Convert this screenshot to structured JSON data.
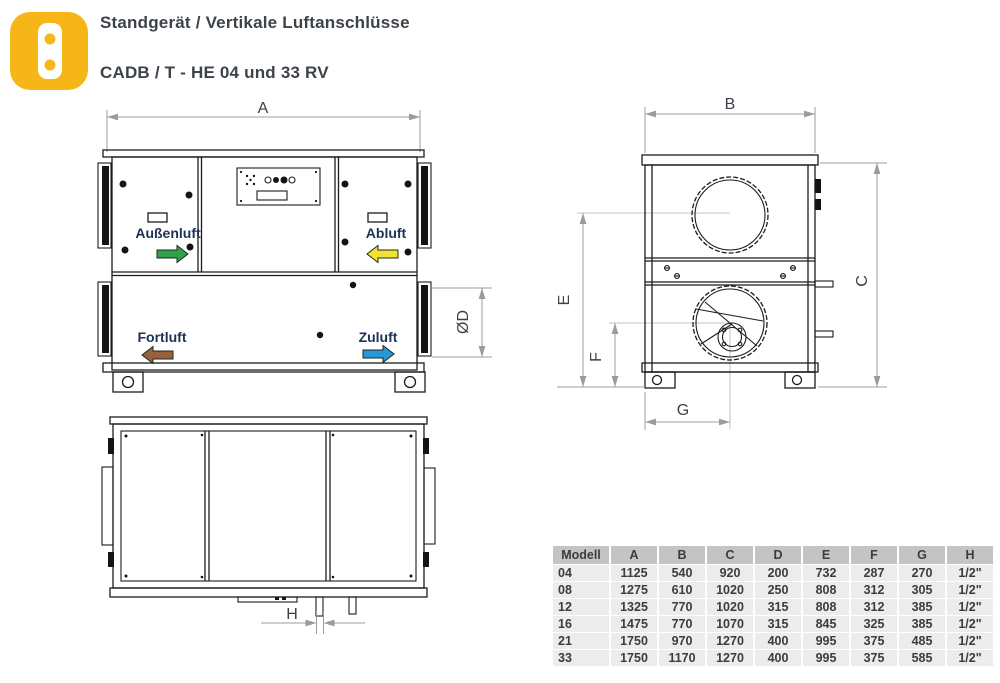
{
  "header": {
    "title": "Standgerät / Vertikale Luftanschlüsse",
    "subtitle": "CADB / T - HE 04 und 33 RV"
  },
  "dimensions": {
    "a": "A",
    "b": "B",
    "c": "C",
    "d": "ØD",
    "e": "E",
    "f": "F",
    "g": "G",
    "h": "H"
  },
  "airflow_labels": {
    "outdoor_air": "Außenluft",
    "extract_air": "Abluft",
    "exhaust_air": "Fortluft",
    "supply_air": "Zuluft"
  },
  "colors": {
    "icon_yellow": "#F7B617",
    "outdoor_air_arrow": "#2FA14B",
    "extract_air_arrow": "#F2E12E",
    "exhaust_air_arrow": "#97613D",
    "supply_air_arrow": "#2598D5"
  },
  "table": {
    "headers": [
      "Modell",
      "A",
      "B",
      "C",
      "D",
      "E",
      "F",
      "G",
      "H"
    ],
    "rows": [
      [
        "04",
        "1125",
        "540",
        "920",
        "200",
        "732",
        "287",
        "270",
        "1/2\""
      ],
      [
        "08",
        "1275",
        "610",
        "1020",
        "250",
        "808",
        "312",
        "305",
        "1/2\""
      ],
      [
        "12",
        "1325",
        "770",
        "1020",
        "315",
        "808",
        "312",
        "385",
        "1/2\""
      ],
      [
        "16",
        "1475",
        "770",
        "1070",
        "315",
        "845",
        "325",
        "385",
        "1/2\""
      ],
      [
        "21",
        "1750",
        "970",
        "1270",
        "400",
        "995",
        "375",
        "485",
        "1/2\""
      ],
      [
        "33",
        "1750",
        "1170",
        "1270",
        "400",
        "995",
        "375",
        "585",
        "1/2\""
      ]
    ]
  }
}
